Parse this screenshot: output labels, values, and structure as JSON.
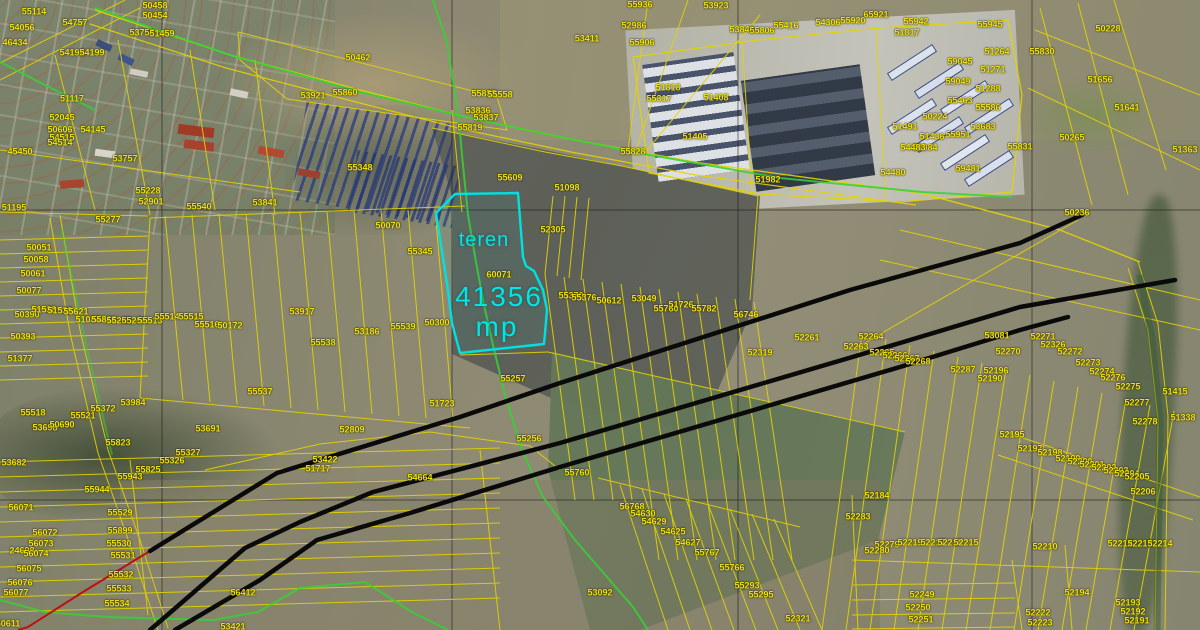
{
  "map": {
    "highlight": {
      "name_label": "teren",
      "area_value": "41356",
      "area_unit": "mp",
      "outline_color": "#00e0e0"
    },
    "colors": {
      "parcel_label": "#f0e10a",
      "parcel_line": "#e3d400",
      "powerline": "#0a0a0a",
      "pipeline": "#bb1111",
      "road_line": "#35d235",
      "grid_line": "#1a1a1a"
    },
    "parcel_labels": [
      {
        "t": "55114",
        "x": 34,
        "y": 12
      },
      {
        "t": "54056",
        "x": 22,
        "y": 28
      },
      {
        "t": "46434",
        "x": 15,
        "y": 43
      },
      {
        "t": "54757",
        "x": 75,
        "y": 23
      },
      {
        "t": "50458",
        "x": 155,
        "y": 6
      },
      {
        "t": "50454",
        "x": 155,
        "y": 16
      },
      {
        "t": "53758",
        "x": 142,
        "y": 33
      },
      {
        "t": "51459",
        "x": 162,
        "y": 34
      },
      {
        "t": "54192",
        "x": 72,
        "y": 53
      },
      {
        "t": "54199",
        "x": 92,
        "y": 53
      },
      {
        "t": "50462",
        "x": 358,
        "y": 58
      },
      {
        "t": "51117",
        "x": 72,
        "y": 99
      },
      {
        "t": "52045",
        "x": 62,
        "y": 118
      },
      {
        "t": "50606",
        "x": 60,
        "y": 130
      },
      {
        "t": "54145",
        "x": 93,
        "y": 130
      },
      {
        "t": "54515",
        "x": 62,
        "y": 138
      },
      {
        "t": "54514",
        "x": 60,
        "y": 143
      },
      {
        "t": "53757",
        "x": 125,
        "y": 159
      },
      {
        "t": "45450",
        "x": 20,
        "y": 152
      },
      {
        "t": "51195",
        "x": 14,
        "y": 208
      },
      {
        "t": "55228",
        "x": 148,
        "y": 191
      },
      {
        "t": "52901",
        "x": 151,
        "y": 202
      },
      {
        "t": "55540",
        "x": 199,
        "y": 207
      },
      {
        "t": "53841",
        "x": 265,
        "y": 203
      },
      {
        "t": "55277",
        "x": 108,
        "y": 220
      },
      {
        "t": "53921",
        "x": 313,
        "y": 96
      },
      {
        "t": "55860",
        "x": 345,
        "y": 93
      },
      {
        "t": "50051",
        "x": 39,
        "y": 248
      },
      {
        "t": "50058",
        "x": 36,
        "y": 260
      },
      {
        "t": "50061",
        "x": 33,
        "y": 274
      },
      {
        "t": "50077",
        "x": 29,
        "y": 291
      },
      {
        "t": "50390",
        "x": 27,
        "y": 315
      },
      {
        "t": "51538",
        "x": 44,
        "y": 310
      },
      {
        "t": "51539",
        "x": 60,
        "y": 311
      },
      {
        "t": "55621",
        "x": 76,
        "y": 312
      },
      {
        "t": "51084",
        "x": 88,
        "y": 320
      },
      {
        "t": "55813",
        "x": 104,
        "y": 320
      },
      {
        "t": "55265",
        "x": 119,
        "y": 321
      },
      {
        "t": "55251",
        "x": 134,
        "y": 321
      },
      {
        "t": "55513",
        "x": 150,
        "y": 321
      },
      {
        "t": "55514",
        "x": 167,
        "y": 317
      },
      {
        "t": "55515",
        "x": 191,
        "y": 317
      },
      {
        "t": "55516",
        "x": 207,
        "y": 325
      },
      {
        "t": "50172",
        "x": 230,
        "y": 326
      },
      {
        "t": "50393",
        "x": 23,
        "y": 337
      },
      {
        "t": "51377",
        "x": 20,
        "y": 359
      },
      {
        "t": "55537",
        "x": 260,
        "y": 392
      },
      {
        "t": "55936",
        "x": 640,
        "y": 5
      },
      {
        "t": "53923",
        "x": 716,
        "y": 6
      },
      {
        "t": "52986",
        "x": 634,
        "y": 26
      },
      {
        "t": "55906",
        "x": 642,
        "y": 43
      },
      {
        "t": "53411",
        "x": 587,
        "y": 39
      },
      {
        "t": "55855",
        "x": 484,
        "y": 94
      },
      {
        "t": "55558",
        "x": 500,
        "y": 95
      },
      {
        "t": "53836",
        "x": 478,
        "y": 111
      },
      {
        "t": "53837",
        "x": 486,
        "y": 118
      },
      {
        "t": "55819",
        "x": 470,
        "y": 128
      },
      {
        "t": "53846",
        "x": 742,
        "y": 30
      },
      {
        "t": "55806",
        "x": 762,
        "y": 31
      },
      {
        "t": "55348",
        "x": 360,
        "y": 168
      },
      {
        "t": "50070",
        "x": 388,
        "y": 226
      },
      {
        "t": "55345",
        "x": 420,
        "y": 252
      },
      {
        "t": "55609",
        "x": 510,
        "y": 178
      },
      {
        "t": "51098",
        "x": 567,
        "y": 188
      },
      {
        "t": "52305",
        "x": 553,
        "y": 230
      },
      {
        "t": "60071",
        "x": 499,
        "y": 275
      },
      {
        "t": "53917",
        "x": 302,
        "y": 312
      },
      {
        "t": "53186",
        "x": 367,
        "y": 332
      },
      {
        "t": "55539",
        "x": 403,
        "y": 327
      },
      {
        "t": "50300",
        "x": 437,
        "y": 323
      },
      {
        "t": "55538",
        "x": 323,
        "y": 343
      },
      {
        "t": "55257",
        "x": 513,
        "y": 379
      },
      {
        "t": "51723",
        "x": 442,
        "y": 404
      },
      {
        "t": "52809",
        "x": 352,
        "y": 430
      },
      {
        "t": "55256",
        "x": 529,
        "y": 439
      },
      {
        "t": "53422",
        "x": 325,
        "y": 460
      },
      {
        "t": "51717",
        "x": 318,
        "y": 469
      },
      {
        "t": "55370",
        "x": 571,
        "y": 296
      },
      {
        "t": "55376",
        "x": 584,
        "y": 298
      },
      {
        "t": "50612",
        "x": 609,
        "y": 301
      },
      {
        "t": "53049",
        "x": 644,
        "y": 299
      },
      {
        "t": "55760",
        "x": 666,
        "y": 309
      },
      {
        "t": "51726",
        "x": 681,
        "y": 305
      },
      {
        "t": "55782",
        "x": 704,
        "y": 309
      },
      {
        "t": "56746",
        "x": 746,
        "y": 315
      },
      {
        "t": "52261",
        "x": 807,
        "y": 338
      },
      {
        "t": "52319",
        "x": 760,
        "y": 353
      },
      {
        "t": "52263",
        "x": 856,
        "y": 347
      },
      {
        "t": "52264",
        "x": 871,
        "y": 337
      },
      {
        "t": "52265",
        "x": 882,
        "y": 353
      },
      {
        "t": "52266",
        "x": 895,
        "y": 356
      },
      {
        "t": "52267",
        "x": 907,
        "y": 359
      },
      {
        "t": "52268",
        "x": 918,
        "y": 362
      },
      {
        "t": "52287",
        "x": 963,
        "y": 370
      },
      {
        "t": "53081",
        "x": 997,
        "y": 336
      },
      {
        "t": "52270",
        "x": 1008,
        "y": 352
      },
      {
        "t": "52196",
        "x": 996,
        "y": 371
      },
      {
        "t": "52190",
        "x": 990,
        "y": 379
      },
      {
        "t": "52271",
        "x": 1043,
        "y": 337
      },
      {
        "t": "52326",
        "x": 1053,
        "y": 345
      },
      {
        "t": "52272",
        "x": 1070,
        "y": 352
      },
      {
        "t": "52273",
        "x": 1088,
        "y": 363
      },
      {
        "t": "52274",
        "x": 1102,
        "y": 372
      },
      {
        "t": "52276",
        "x": 1113,
        "y": 378
      },
      {
        "t": "52275",
        "x": 1128,
        "y": 387
      },
      {
        "t": "52277",
        "x": 1137,
        "y": 403
      },
      {
        "t": "52278",
        "x": 1145,
        "y": 422
      },
      {
        "t": "51415",
        "x": 1175,
        "y": 392
      },
      {
        "t": "51338",
        "x": 1183,
        "y": 418
      },
      {
        "t": "55317",
        "x": 659,
        "y": 99
      },
      {
        "t": "51818",
        "x": 668,
        "y": 88
      },
      {
        "t": "51408",
        "x": 716,
        "y": 98
      },
      {
        "t": "51405",
        "x": 695,
        "y": 137
      },
      {
        "t": "55828",
        "x": 633,
        "y": 152
      },
      {
        "t": "51982",
        "x": 768,
        "y": 180
      },
      {
        "t": "55416",
        "x": 786,
        "y": 26
      },
      {
        "t": "54306",
        "x": 828,
        "y": 23
      },
      {
        "t": "55920",
        "x": 853,
        "y": 21
      },
      {
        "t": "65921",
        "x": 876,
        "y": 15
      },
      {
        "t": "55942",
        "x": 916,
        "y": 22
      },
      {
        "t": "51817",
        "x": 907,
        "y": 33
      },
      {
        "t": "55945",
        "x": 990,
        "y": 25
      },
      {
        "t": "51264",
        "x": 997,
        "y": 52
      },
      {
        "t": "59045",
        "x": 960,
        "y": 62
      },
      {
        "t": "51271",
        "x": 993,
        "y": 70
      },
      {
        "t": "59049",
        "x": 958,
        "y": 82
      },
      {
        "t": "51288",
        "x": 988,
        "y": 89
      },
      {
        "t": "55463",
        "x": 960,
        "y": 101
      },
      {
        "t": "55586",
        "x": 988,
        "y": 108
      },
      {
        "t": "50224",
        "x": 935,
        "y": 117
      },
      {
        "t": "53683",
        "x": 983,
        "y": 127
      },
      {
        "t": "51436",
        "x": 932,
        "y": 137
      },
      {
        "t": "55951",
        "x": 958,
        "y": 135
      },
      {
        "t": "51984",
        "x": 925,
        "y": 148
      },
      {
        "t": "59481",
        "x": 968,
        "y": 169
      },
      {
        "t": "51491",
        "x": 905,
        "y": 127
      },
      {
        "t": "54483",
        "x": 913,
        "y": 148
      },
      {
        "t": "54480",
        "x": 893,
        "y": 173
      },
      {
        "t": "50228",
        "x": 1108,
        "y": 29
      },
      {
        "t": "55830",
        "x": 1042,
        "y": 52
      },
      {
        "t": "51656",
        "x": 1100,
        "y": 80
      },
      {
        "t": "51641",
        "x": 1127,
        "y": 108
      },
      {
        "t": "50265",
        "x": 1072,
        "y": 138
      },
      {
        "t": "55831",
        "x": 1020,
        "y": 147
      },
      {
        "t": "51363",
        "x": 1185,
        "y": 150
      },
      {
        "t": "50236",
        "x": 1077,
        "y": 213
      },
      {
        "t": "55518",
        "x": 33,
        "y": 413
      },
      {
        "t": "55521",
        "x": 83,
        "y": 416
      },
      {
        "t": "55372",
        "x": 103,
        "y": 409
      },
      {
        "t": "53984",
        "x": 133,
        "y": 403
      },
      {
        "t": "53698",
        "x": 45,
        "y": 428
      },
      {
        "t": "50690",
        "x": 62,
        "y": 425
      },
      {
        "t": "53691",
        "x": 208,
        "y": 429
      },
      {
        "t": "53682",
        "x": 14,
        "y": 463
      },
      {
        "t": "55823",
        "x": 118,
        "y": 443
      },
      {
        "t": "55825",
        "x": 148,
        "y": 470
      },
      {
        "t": "55943",
        "x": 130,
        "y": 477
      },
      {
        "t": "55944",
        "x": 97,
        "y": 490
      },
      {
        "t": "55327",
        "x": 188,
        "y": 453
      },
      {
        "t": "55326",
        "x": 172,
        "y": 461
      },
      {
        "t": "56071",
        "x": 21,
        "y": 508
      },
      {
        "t": "56072",
        "x": 45,
        "y": 533
      },
      {
        "t": "56073",
        "x": 41,
        "y": 544
      },
      {
        "t": "24698",
        "x": 22,
        "y": 551
      },
      {
        "t": "56074",
        "x": 36,
        "y": 554
      },
      {
        "t": "56075",
        "x": 29,
        "y": 569
      },
      {
        "t": "56076",
        "x": 20,
        "y": 583
      },
      {
        "t": "56077",
        "x": 16,
        "y": 593
      },
      {
        "t": "55529",
        "x": 120,
        "y": 513
      },
      {
        "t": "55899",
        "x": 120,
        "y": 531
      },
      {
        "t": "55530",
        "x": 119,
        "y": 544
      },
      {
        "t": "55531",
        "x": 123,
        "y": 556
      },
      {
        "t": "55532",
        "x": 121,
        "y": 575
      },
      {
        "t": "55533",
        "x": 119,
        "y": 589
      },
      {
        "t": "55534",
        "x": 117,
        "y": 604
      },
      {
        "t": "50611",
        "x": 8,
        "y": 624
      },
      {
        "t": "56412",
        "x": 243,
        "y": 593
      },
      {
        "t": "53421",
        "x": 233,
        "y": 627
      },
      {
        "t": "54664",
        "x": 420,
        "y": 478
      },
      {
        "t": "55760",
        "x": 577,
        "y": 473
      },
      {
        "t": "56768",
        "x": 632,
        "y": 507
      },
      {
        "t": "54630",
        "x": 643,
        "y": 514
      },
      {
        "t": "54629",
        "x": 654,
        "y": 522
      },
      {
        "t": "54625",
        "x": 673,
        "y": 532
      },
      {
        "t": "54627",
        "x": 688,
        "y": 543
      },
      {
        "t": "55767",
        "x": 707,
        "y": 553
      },
      {
        "t": "55766",
        "x": 732,
        "y": 568
      },
      {
        "t": "53092",
        "x": 600,
        "y": 593
      },
      {
        "t": "55293",
        "x": 747,
        "y": 586
      },
      {
        "t": "55295",
        "x": 761,
        "y": 595
      },
      {
        "t": "52321",
        "x": 798,
        "y": 619
      },
      {
        "t": "52195",
        "x": 1012,
        "y": 435
      },
      {
        "t": "52197",
        "x": 1030,
        "y": 449
      },
      {
        "t": "52198",
        "x": 1050,
        "y": 453
      },
      {
        "t": "52199",
        "x": 1068,
        "y": 459
      },
      {
        "t": "52200",
        "x": 1080,
        "y": 462
      },
      {
        "t": "52201",
        "x": 1092,
        "y": 465
      },
      {
        "t": "52202",
        "x": 1104,
        "y": 468
      },
      {
        "t": "52203",
        "x": 1116,
        "y": 471
      },
      {
        "t": "52204",
        "x": 1127,
        "y": 474
      },
      {
        "t": "52205",
        "x": 1137,
        "y": 477
      },
      {
        "t": "52206",
        "x": 1143,
        "y": 492
      },
      {
        "t": "52184",
        "x": 877,
        "y": 496
      },
      {
        "t": "52283",
        "x": 858,
        "y": 517
      },
      {
        "t": "52279",
        "x": 887,
        "y": 545
      },
      {
        "t": "52280",
        "x": 877,
        "y": 551
      },
      {
        "t": "52219",
        "x": 910,
        "y": 543
      },
      {
        "t": "52217",
        "x": 933,
        "y": 543
      },
      {
        "t": "52218",
        "x": 950,
        "y": 543
      },
      {
        "t": "52215",
        "x": 966,
        "y": 543
      },
      {
        "t": "52210",
        "x": 1045,
        "y": 547
      },
      {
        "t": "52212",
        "x": 1120,
        "y": 544
      },
      {
        "t": "52213",
        "x": 1140,
        "y": 544
      },
      {
        "t": "52214",
        "x": 1160,
        "y": 544
      },
      {
        "t": "52249",
        "x": 922,
        "y": 595
      },
      {
        "t": "52250",
        "x": 918,
        "y": 608
      },
      {
        "t": "52251",
        "x": 921,
        "y": 620
      },
      {
        "t": "52194",
        "x": 1077,
        "y": 593
      },
      {
        "t": "52222",
        "x": 1038,
        "y": 613
      },
      {
        "t": "52223",
        "x": 1040,
        "y": 623
      },
      {
        "t": "52193",
        "x": 1128,
        "y": 603
      },
      {
        "t": "52192",
        "x": 1133,
        "y": 612
      },
      {
        "t": "52191",
        "x": 1137,
        "y": 621
      }
    ]
  }
}
